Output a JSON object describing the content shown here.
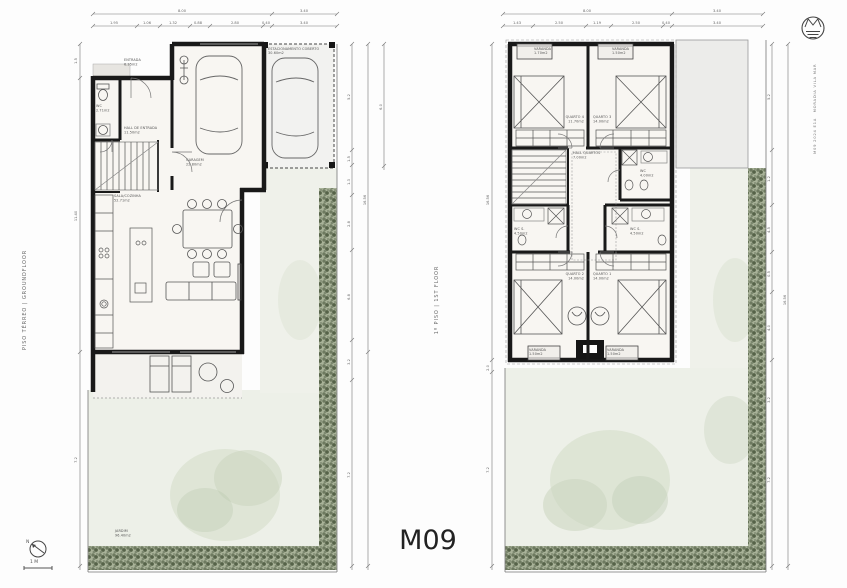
{
  "sheet": {
    "code": "M09",
    "scale_label": "1 M",
    "north_label": "N"
  },
  "brand": {
    "logo": "wave-monogram",
    "line1": "MORADIA VILA MAR",
    "line2": "M09 2024 E1A"
  },
  "ground_floor": {
    "title": "PISO TÉRREO | GROUNDFLOOR",
    "rooms": [
      {
        "name": "ENTRADA",
        "area": "6.35m2"
      },
      {
        "name": "WC",
        "area": "2.71m2"
      },
      {
        "name": "HALL DE ENTRADA",
        "area": "11.50m2"
      },
      {
        "name": "GARAGEM",
        "area": "22.80m2"
      },
      {
        "name": "SALA/COZINHA",
        "area": "52.71m2"
      },
      {
        "name": "ESTACIONAMENTO COBERTO",
        "area": "30.60m2"
      },
      {
        "name": "JARDIM",
        "area": "96.40m2"
      }
    ],
    "dims": {
      "top_totals": [
        "8.00",
        "3.40"
      ],
      "top_segments": [
        "1.95",
        "1.06",
        "1.32",
        "0.88",
        "2.80",
        "0.40",
        "3.40"
      ],
      "left": [
        "1.5",
        "11.40",
        "7.2"
      ],
      "right_segments": [
        "5.2",
        "1.5",
        "1.3",
        "2.8",
        "6.8",
        "3.2",
        "7.2"
      ],
      "right_total": "16.56",
      "right_outer": "6.0"
    }
  },
  "first_floor": {
    "title": "1º PISO | 1ST FLOOR",
    "rooms": [
      {
        "name": "VARANDA",
        "area": "1.70m2"
      },
      {
        "name": "VARANDA",
        "area": "1.50m2"
      },
      {
        "name": "QUARTO 4",
        "area": "11.70m2"
      },
      {
        "name": "QUARTO 3",
        "area": "14.00m2"
      },
      {
        "name": "HALL QUARTOS",
        "area": "7.00m2"
      },
      {
        "name": "WC",
        "area": "4.00m2"
      },
      {
        "name": "WC S.",
        "area": "4.50m2"
      },
      {
        "name": "WC S.",
        "area": "4.50m2"
      },
      {
        "name": "QUARTO 2",
        "area": "14.00m2"
      },
      {
        "name": "QUARTO 1",
        "area": "14.00m2"
      },
      {
        "name": "VARANDA",
        "area": "1.50m2"
      },
      {
        "name": "VARANDA",
        "area": "1.50m2"
      }
    ],
    "dims": {
      "top_totals": [
        "8.00",
        "3.40"
      ],
      "top_segments": [
        "1.43",
        "2.50",
        "1.19",
        "2.50",
        "0.40",
        "3.40"
      ],
      "left": [
        "16.56",
        "2.0",
        "7.2"
      ],
      "right_segments": [
        "5.2",
        "1.2",
        "4.5",
        "0.5",
        "4.0",
        "3.2",
        "7.2"
      ],
      "right_total": "16.56"
    }
  }
}
